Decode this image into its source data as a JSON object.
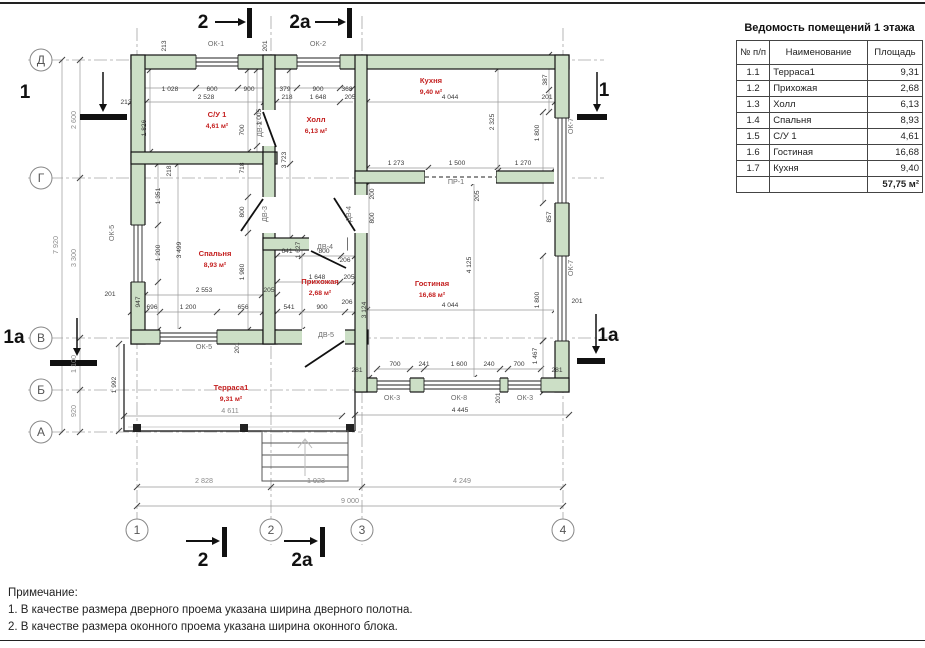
{
  "table": {
    "title": "Ведомость помещений 1 этажа",
    "headers": [
      "№ п/п",
      "Наименование",
      "Площадь"
    ],
    "rows": [
      [
        "1.1",
        "Терраса1",
        "9,31"
      ],
      [
        "1.2",
        "Прихожая",
        "2,68"
      ],
      [
        "1.3",
        "Холл",
        "6,13"
      ],
      [
        "1.4",
        "Спальня",
        "8,93"
      ],
      [
        "1.5",
        "С/У 1",
        "4,61"
      ],
      [
        "1.6",
        "Гостиная",
        "16,68"
      ],
      [
        "1.7",
        "Кухня",
        "9,40"
      ]
    ],
    "total": "57,75 м²"
  },
  "notes": {
    "title": "Примечание:",
    "line1": "1. В качестве размера дверного проема указана ширина дверного полотна.",
    "line2": "2. В качестве размера оконного проема указана ширина оконного блока."
  },
  "plan": {
    "rooms": [
      {
        "name": "С/У 1",
        "area": "4,61 м²",
        "x": 217,
        "y": 117
      },
      {
        "name": "Холл",
        "area": "6,13 м²",
        "x": 316,
        "y": 122
      },
      {
        "name": "Кухня",
        "area": "9,40 м²",
        "x": 431,
        "y": 83
      },
      {
        "name": "Спальня",
        "area": "8,93 м²",
        "x": 215,
        "y": 256
      },
      {
        "name": "Прихожая",
        "area": "2,68 м²",
        "x": 320,
        "y": 284
      },
      {
        "name": "Гостиная",
        "area": "16,68 м²",
        "x": 432,
        "y": 286
      },
      {
        "name": "Терраса1",
        "area": "9,31 м²",
        "x": 231,
        "y": 390
      }
    ],
    "grid_rows": [
      {
        "label": "Д",
        "y": 60
      },
      {
        "label": "Г",
        "y": 178
      },
      {
        "label": "В",
        "y": 338
      },
      {
        "label": "Б",
        "y": 390
      },
      {
        "label": "А",
        "y": 432
      }
    ],
    "grid_cols": [
      {
        "label": "1",
        "x": 137
      },
      {
        "label": "2",
        "x": 271
      },
      {
        "label": "3",
        "x": 362
      },
      {
        "label": "4",
        "x": 563
      }
    ],
    "sections": [
      {
        "t": "2",
        "x": 203,
        "y": 28
      },
      {
        "t": "2a",
        "x": 300,
        "y": 28
      },
      {
        "t": "2",
        "x": 203,
        "y": 566
      },
      {
        "t": "2a",
        "x": 302,
        "y": 566
      },
      {
        "t": "1",
        "x": 25,
        "y": 98
      },
      {
        "t": "1",
        "x": 604,
        "y": 96
      },
      {
        "t": "1a",
        "x": 14,
        "y": 343
      },
      {
        "t": "1a",
        "x": 608,
        "y": 341
      }
    ],
    "openings": [
      {
        "t": "ОК-1",
        "x": 216,
        "y": 46
      },
      {
        "t": "ОК-2",
        "x": 318,
        "y": 46
      },
      {
        "t": "ОК-5",
        "x": 114,
        "y": 233,
        "r": 1
      },
      {
        "t": "ОК-5",
        "x": 204,
        "y": 349
      },
      {
        "t": "ОК-7",
        "x": 573,
        "y": 126,
        "r": 1
      },
      {
        "t": "ОК-7",
        "x": 573,
        "y": 268,
        "r": 1
      },
      {
        "t": "ОК-3",
        "x": 392,
        "y": 400
      },
      {
        "t": "ОК-8",
        "x": 459,
        "y": 400
      },
      {
        "t": "ОК-3",
        "x": 525,
        "y": 400
      },
      {
        "t": "ПР-1",
        "x": 456,
        "y": 184
      },
      {
        "t": "ДВ-4",
        "x": 325,
        "y": 249
      },
      {
        "t": "ДВ-4",
        "x": 351,
        "y": 214,
        "r": 1
      },
      {
        "t": "ДВ-3",
        "x": 267,
        "y": 214,
        "r": 1
      },
      {
        "t": "ДВ-5",
        "x": 326,
        "y": 337
      },
      {
        "t": "ДВ-2",
        "x": 262,
        "y": 129,
        "r": 1,
        "s": 1
      }
    ],
    "dims": [
      {
        "t": "213",
        "x": 126,
        "y": 104
      },
      {
        "t": "1 028",
        "x": 170,
        "y": 91
      },
      {
        "t": "600",
        "x": 212,
        "y": 91
      },
      {
        "t": "900",
        "x": 249,
        "y": 91
      },
      {
        "t": "379",
        "x": 285,
        "y": 91
      },
      {
        "t": "900",
        "x": 318,
        "y": 91
      },
      {
        "t": "368",
        "x": 347,
        "y": 91
      },
      {
        "t": "2 528",
        "x": 206,
        "y": 99
      },
      {
        "t": "218",
        "x": 287,
        "y": 99
      },
      {
        "t": "1 648",
        "x": 318,
        "y": 99
      },
      {
        "t": "205",
        "x": 350,
        "y": 99
      },
      {
        "t": "4 044",
        "x": 450,
        "y": 99
      },
      {
        "t": "201",
        "x": 547,
        "y": 99
      },
      {
        "t": "213",
        "x": 166,
        "y": 46,
        "r": 1
      },
      {
        "t": "201",
        "x": 267,
        "y": 46,
        "r": 1
      },
      {
        "t": "387",
        "x": 547,
        "y": 80,
        "r": 1
      },
      {
        "t": "1 826",
        "x": 146,
        "y": 128,
        "r": 1
      },
      {
        "t": "1 005",
        "x": 261,
        "y": 117,
        "r": 1
      },
      {
        "t": "700",
        "x": 244,
        "y": 130,
        "r": 1
      },
      {
        "t": "3 723",
        "x": 286,
        "y": 160,
        "r": 1
      },
      {
        "t": "2 325",
        "x": 494,
        "y": 122,
        "r": 1
      },
      {
        "t": "1 800",
        "x": 539,
        "y": 133,
        "r": 1
      },
      {
        "t": "1 273",
        "x": 396,
        "y": 165
      },
      {
        "t": "1 500",
        "x": 457,
        "y": 165
      },
      {
        "t": "1 270",
        "x": 523,
        "y": 165
      },
      {
        "t": "205",
        "x": 479,
        "y": 196,
        "r": 1
      },
      {
        "t": "857",
        "x": 551,
        "y": 217,
        "r": 1
      },
      {
        "t": "200",
        "x": 374,
        "y": 194,
        "r": 1
      },
      {
        "t": "800",
        "x": 374,
        "y": 218,
        "r": 1
      },
      {
        "t": "218",
        "x": 171,
        "y": 171,
        "r": 1
      },
      {
        "t": "1 351",
        "x": 160,
        "y": 196,
        "r": 1
      },
      {
        "t": "1 200",
        "x": 160,
        "y": 253,
        "r": 1
      },
      {
        "t": "3 499",
        "x": 181,
        "y": 250,
        "r": 1
      },
      {
        "t": "718",
        "x": 244,
        "y": 168,
        "r": 1
      },
      {
        "t": "800",
        "x": 244,
        "y": 212,
        "r": 1
      },
      {
        "t": "1 980",
        "x": 244,
        "y": 272,
        "r": 1
      },
      {
        "t": "2 553",
        "x": 204,
        "y": 292
      },
      {
        "t": "205",
        "x": 269,
        "y": 292
      },
      {
        "t": "947",
        "x": 140,
        "y": 302,
        "r": 1
      },
      {
        "t": "201",
        "x": 110,
        "y": 296
      },
      {
        "t": "696",
        "x": 152,
        "y": 309
      },
      {
        "t": "1 200",
        "x": 188,
        "y": 309
      },
      {
        "t": "656",
        "x": 243,
        "y": 309
      },
      {
        "t": "541",
        "x": 289,
        "y": 309
      },
      {
        "t": "900",
        "x": 322,
        "y": 309
      },
      {
        "t": "206",
        "x": 347,
        "y": 304
      },
      {
        "t": "641",
        "x": 287,
        "y": 253
      },
      {
        "t": "800",
        "x": 324,
        "y": 253
      },
      {
        "t": "206",
        "x": 345,
        "y": 262
      },
      {
        "t": "1 627",
        "x": 300,
        "y": 250,
        "r": 1
      },
      {
        "t": "1 648",
        "x": 317,
        "y": 279
      },
      {
        "t": "205",
        "x": 349,
        "y": 279
      },
      {
        "t": "3 124",
        "x": 366,
        "y": 310,
        "r": 1
      },
      {
        "t": "4 125",
        "x": 471,
        "y": 265,
        "r": 1
      },
      {
        "t": "4 044",
        "x": 450,
        "y": 307
      },
      {
        "t": "1 800",
        "x": 539,
        "y": 300,
        "r": 1
      },
      {
        "t": "1 467",
        "x": 537,
        "y": 356,
        "r": 1
      },
      {
        "t": "201",
        "x": 577,
        "y": 303
      },
      {
        "t": "281",
        "x": 357,
        "y": 372
      },
      {
        "t": "281",
        "x": 557,
        "y": 372
      },
      {
        "t": "700",
        "x": 395,
        "y": 366
      },
      {
        "t": "241",
        "x": 424,
        "y": 366
      },
      {
        "t": "1 600",
        "x": 459,
        "y": 366
      },
      {
        "t": "240",
        "x": 489,
        "y": 366
      },
      {
        "t": "700",
        "x": 519,
        "y": 366
      },
      {
        "t": "201",
        "x": 500,
        "y": 398,
        "r": 1
      },
      {
        "t": "4 445",
        "x": 460,
        "y": 412
      },
      {
        "t": "4 611",
        "x": 230,
        "y": 413,
        "f": 1
      },
      {
        "t": "1 992",
        "x": 116,
        "y": 385,
        "r": 1
      },
      {
        "t": "201",
        "x": 239,
        "y": 348,
        "r": 1
      },
      {
        "t": "2 600",
        "x": 76,
        "y": 120,
        "r": 1,
        "f": 1
      },
      {
        "t": "7 920",
        "x": 58,
        "y": 245,
        "r": 1,
        "f": 1
      },
      {
        "t": "3 300",
        "x": 76,
        "y": 258,
        "r": 1,
        "f": 1
      },
      {
        "t": "1 100",
        "x": 76,
        "y": 364,
        "r": 1,
        "f": 1
      },
      {
        "t": "920",
        "x": 76,
        "y": 411,
        "r": 1,
        "f": 1
      },
      {
        "t": "2 828",
        "x": 204,
        "y": 483,
        "f": 1
      },
      {
        "t": "1 923",
        "x": 316,
        "y": 483,
        "f": 1
      },
      {
        "t": "4 249",
        "x": 462,
        "y": 483,
        "f": 1
      },
      {
        "t": "9 000",
        "x": 350,
        "y": 503,
        "f": 1
      }
    ]
  },
  "colors": {
    "wall_fill": "#ccdfc6",
    "wall_stroke": "#141414",
    "room_label": "#c42020",
    "dim_text": "#3a3a3a",
    "grid_line": "#a5a5a5"
  }
}
